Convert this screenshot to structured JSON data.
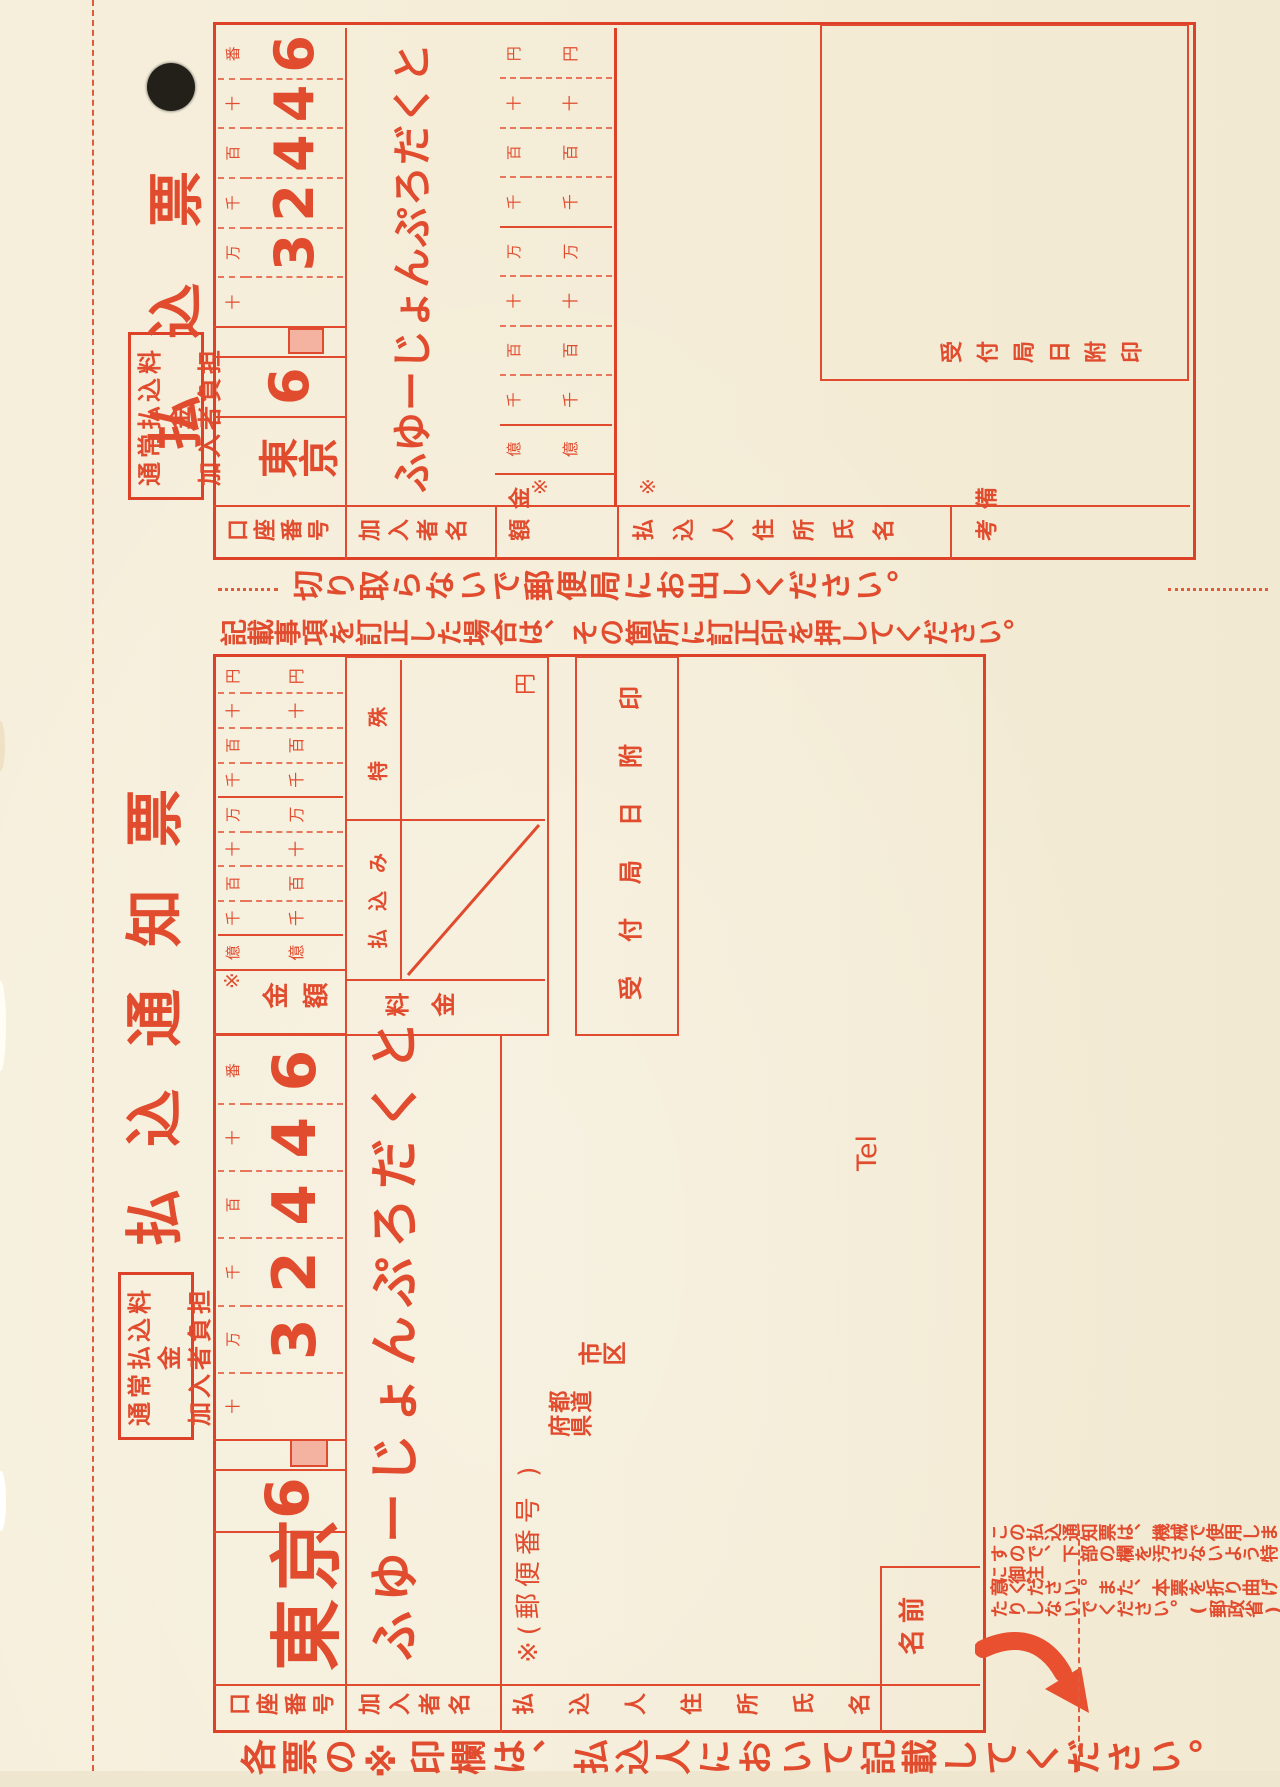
{
  "ink_color": "#e14b2e",
  "paper_color": "#f5eedb",
  "shared": {
    "fee_box_line1": "通常払込料金",
    "fee_box_line2": "加入者負担",
    "asterisk": "※",
    "account_place_headers": [
      "十",
      "万",
      "千",
      "百",
      "十",
      "番"
    ],
    "amount_place_headers": [
      "億",
      "千",
      "百",
      "十",
      "万",
      "千",
      "百",
      "十",
      "円"
    ],
    "account_office": "東京",
    "account_prefix": "6",
    "account_digit_cells": [
      "",
      "3",
      "2",
      "4",
      "4",
      "6"
    ],
    "subscriber_name": "ふゆーじょんぷろだくと"
  },
  "left_slip": {
    "title": "払込通知票",
    "labels": {
      "account": "口座番号",
      "subscriber": "加入者名",
      "amount": "金額",
      "fee": "料金",
      "payment": "払込み",
      "special": "特殊",
      "yen": "円",
      "payer": "払込人住所氏名",
      "stamp": "受付局日附印",
      "postal": "※(郵便番号      )",
      "prefecture": "都道府県",
      "city": "市区",
      "tel": "Tel",
      "name": "名前"
    }
  },
  "right_slip": {
    "title": "払込票",
    "labels": {
      "account": "口座番号",
      "subscriber": "加入者名",
      "amount": "金 額",
      "payer": "払込人住所氏名",
      "remarks": "備 考",
      "stamp": "受付局日附印"
    }
  },
  "notices": {
    "perforation": "切り取らないで郵便局にお出しください。",
    "perforation_dots": "・・・・・・",
    "correction": "記載事項を訂正した場合は、その箇所に訂正印を押してください。",
    "machine_line1": "この払込通知票は、機械で使用しますので、下部の欄を汚さないよう特に御注",
    "machine_line2": "意ください。また、本票を折り曲げたりしないでください。",
    "ministry": "(郵政省)",
    "fill_note": "各票の※印欄は、払込人において記載してください。"
  }
}
